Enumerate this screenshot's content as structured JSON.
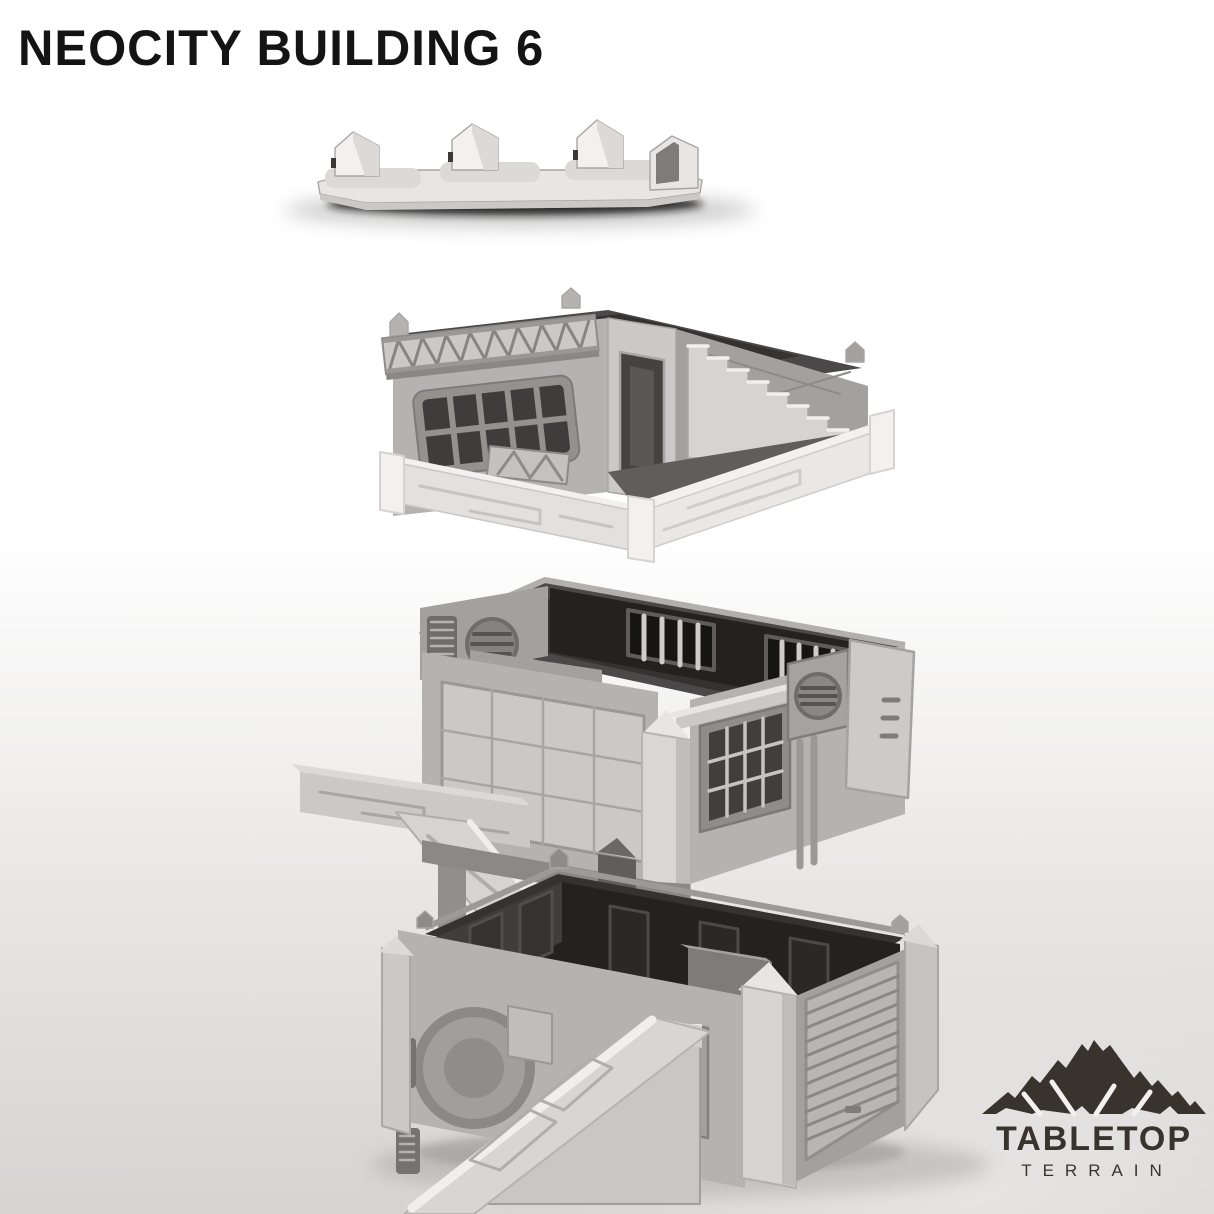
{
  "background": {
    "top": "#ffffff",
    "bottom": "#d6d4d3"
  },
  "title": {
    "text": "NEOCITY BUILDING 6",
    "color": "#141414"
  },
  "logo": {
    "brand": "TABLETOP",
    "sub": "TERRAIN",
    "color": "#39332e",
    "icon": "mountain-icon"
  },
  "model": {
    "colors": {
      "plastic_light": "#e9e7e6",
      "plastic_mid": "#b5b3b2",
      "plastic_dark": "#8e8c8b",
      "interior_dark": "#2d2c2b"
    },
    "pieces": [
      "roof-cap",
      "penthouse-level",
      "upper-floor",
      "ground-floor"
    ]
  }
}
